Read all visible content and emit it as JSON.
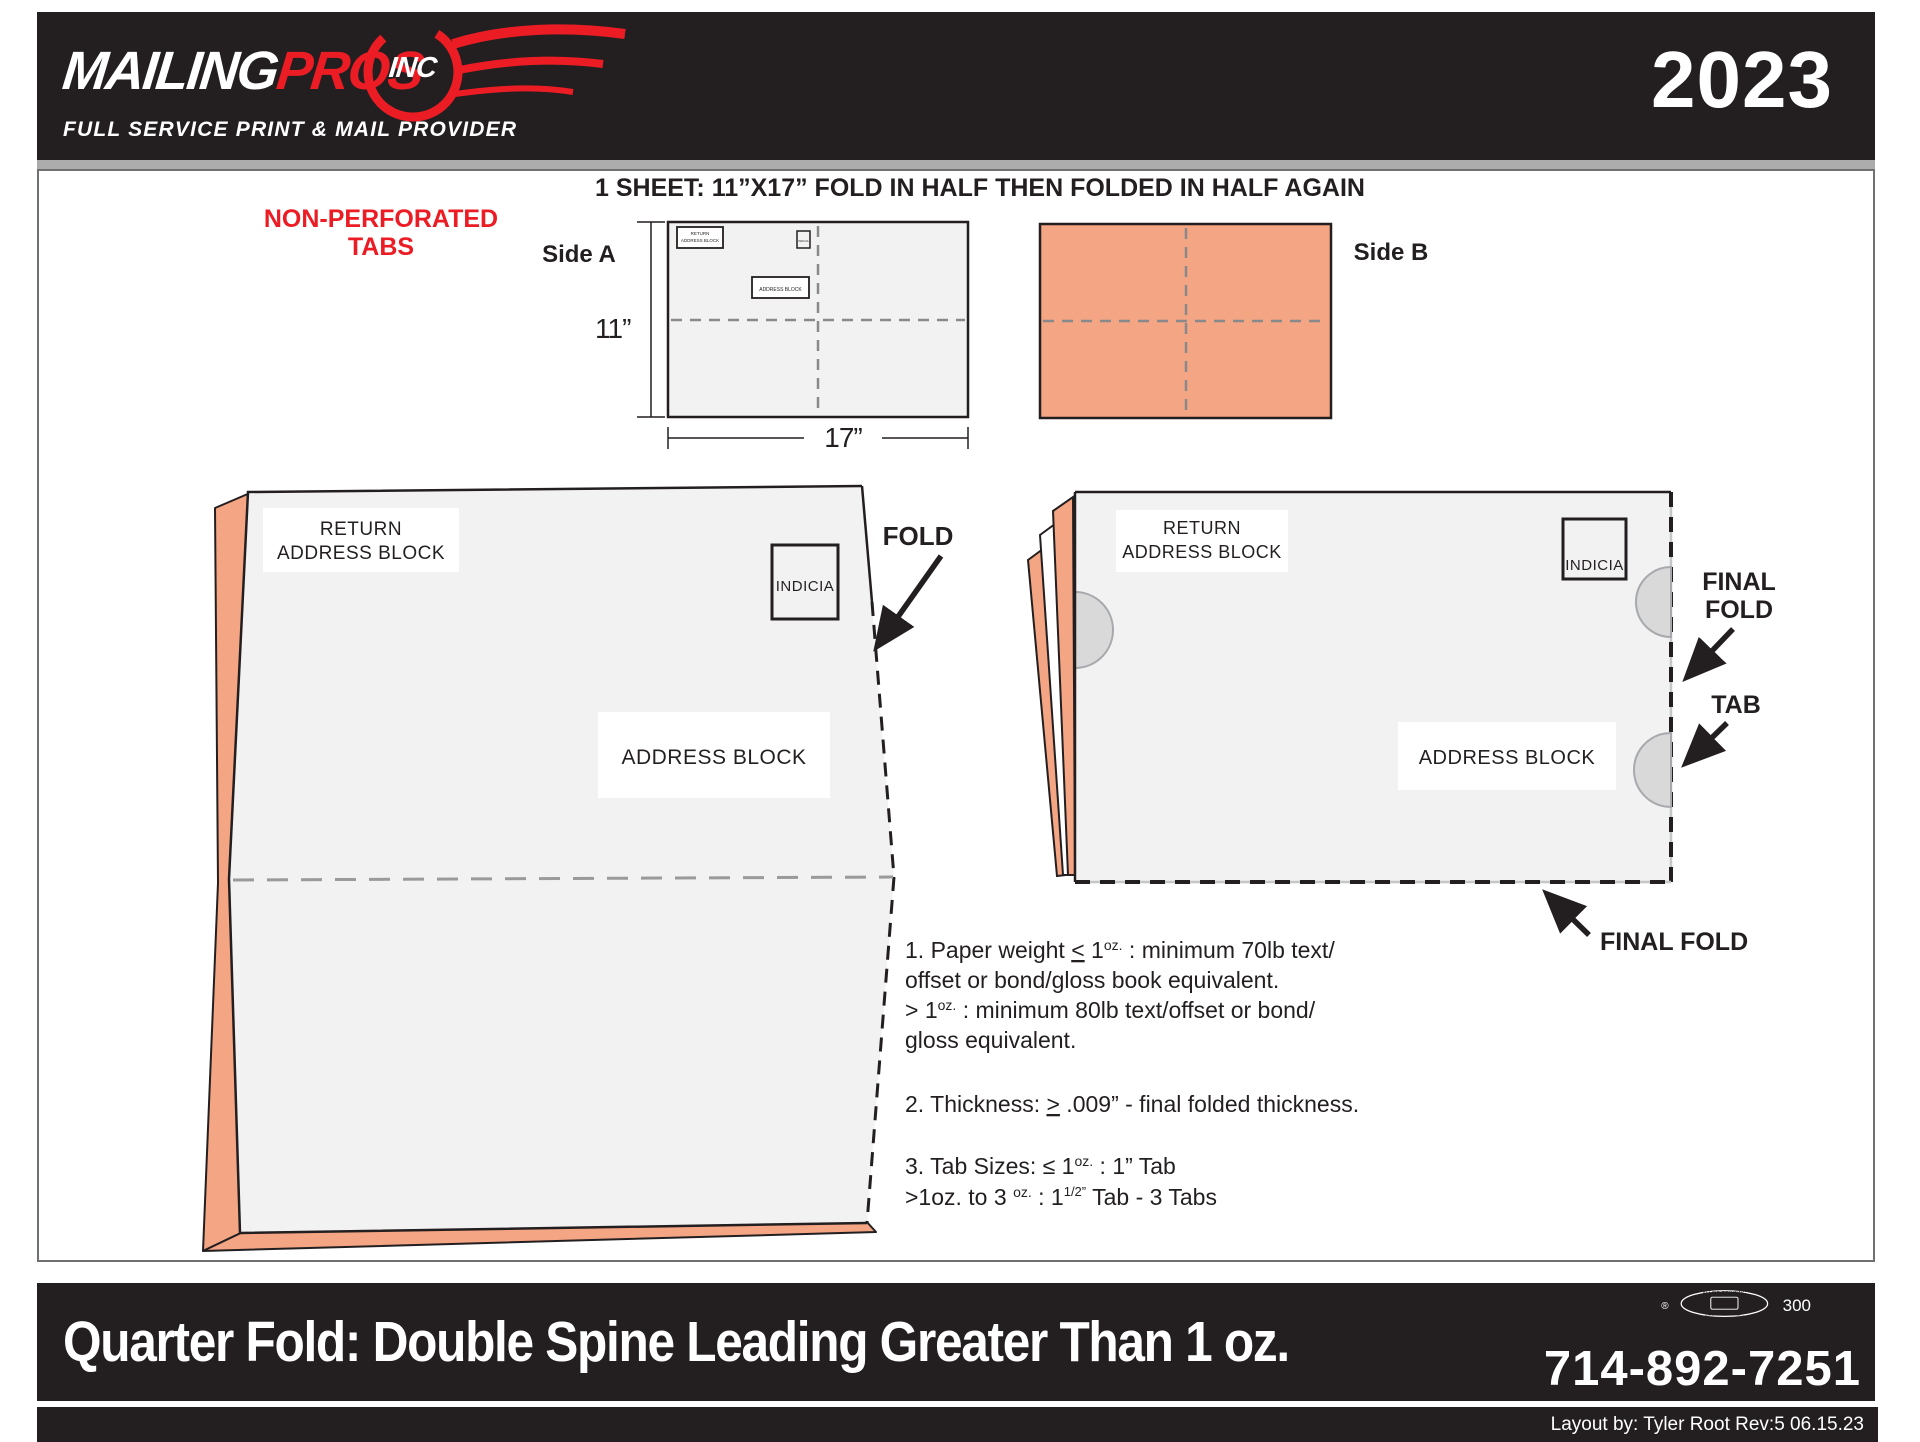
{
  "colors": {
    "accent_red": "#EC1C24",
    "salmon": "#F4A583",
    "ink_black": "#231F20"
  },
  "header": {
    "logo_mailing": "MAILING",
    "logo_pros": "PROS",
    "logo_inc": "INC",
    "tagline": "FULL SERVICE PRINT & MAIL PROVIDER",
    "year": "2023"
  },
  "diagram": {
    "title": "1 SHEET: 11”X17” FOLD IN HALF THEN FOLDED IN HALF AGAIN",
    "non_perforated_line1": "NON-PERFORATED",
    "non_perforated_line2": "TABS",
    "side_a_label": "Side A",
    "side_b_label": "Side B",
    "dim_height": "11”",
    "dim_width": "17”",
    "return_line1": "RETURN",
    "return_line2": "ADDRESS BLOCK",
    "indicia": "INDICIA",
    "address_block": "ADDRESS BLOCK",
    "fold_label": "FOLD",
    "final_fold_line1": "FINAL",
    "final_fold_line2": "FOLD",
    "tab_label": "TAB",
    "final_fold_bottom": "FINAL FOLD"
  },
  "notes": {
    "n1s1": "1. Paper weight ",
    "n1_lte": "<",
    "n1s2": " 1",
    "n1_sup": "oz.",
    "n1s3": " : minimum 70lb text/",
    "n1l2": "offset or bond/gloss book equivalent.",
    "n1l3a": "> 1",
    "n1l3sup": "oz.",
    "n1l3b": " : minimum 80lb text/offset or bond/",
    "n1l4": "gloss equivalent.",
    "n2a": "2. Thickness: ",
    "n2_gte": ">",
    "n2b": " .009” - final folded thickness.",
    "n3a": "3. Tab Sizes: ≤ 1",
    "n3sup": "oz.",
    "n3b": " : 1” Tab",
    "n3l2a": ">1oz. to 3 ",
    "n3l2sup": "oz.",
    "n3l2b": " : 1",
    "n3l2sup2": "1/2”",
    "n3l2c": " Tab - 3 Tabs"
  },
  "footer": {
    "title": "Quarter Fold: Double Spine Leading Greater Than 1 oz.",
    "phone": "714-892-7251",
    "credit": "Layout by: Tyler Root Rev:5 06.15.23",
    "registered_mark": "®",
    "union_number": "300",
    "bug_allied": "ALLIED PRINTING",
    "bug_trades": "TRADES",
    "bug_union": "UNION",
    "bug_label": "LABEL",
    "bug_council": "COUNCIL",
    "bug_southern": "SOUTHERN CALIF.",
    "bug_mailing": "MAILING PROS INC."
  }
}
